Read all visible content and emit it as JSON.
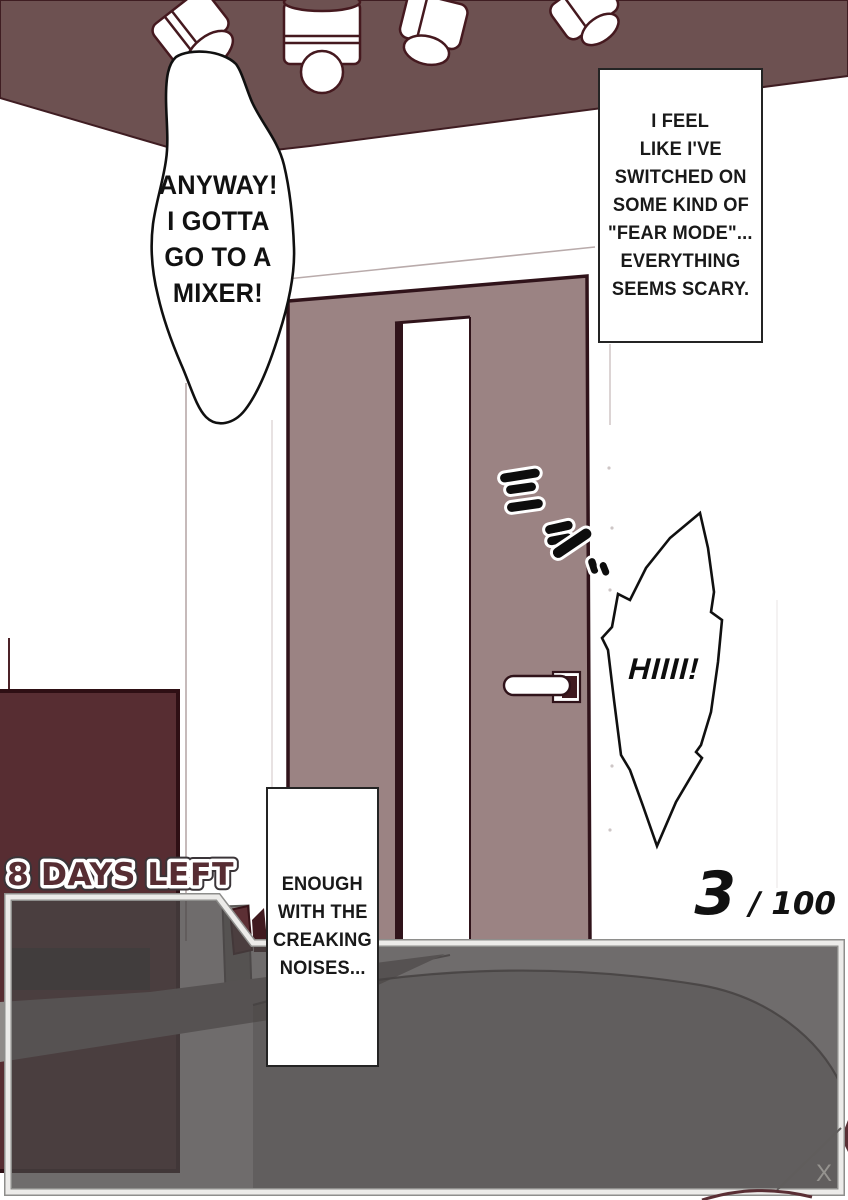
{
  "panel": {
    "speech_mixer": {
      "lines": [
        "ANYWAY!",
        "I GOTTA",
        "GO TO A",
        "MIXER!"
      ]
    },
    "caption_fear": {
      "lines": [
        "I FEEL",
        "LIKE I'VE",
        "SWITCHED ON",
        "SOME KIND OF",
        "\"FEAR MODE\"...",
        "EVERYTHING",
        "SEEMS SCARY."
      ]
    },
    "speech_hiii": {
      "text": "HIIII!"
    },
    "caption_creaking": {
      "lines": [
        "ENOUGH",
        "WITH THE",
        "CREAKING",
        "NOISES..."
      ]
    },
    "sfx_creak": {
      "name": "creak-sound-effect"
    }
  },
  "hud": {
    "days_left": "8 DAYS LEFT",
    "counter": {
      "current": "3",
      "total": "/ 100"
    },
    "dialog_close": "X"
  },
  "colors": {
    "ceiling": "#6d5151",
    "door": "#9b8383",
    "door_outline": "#30131a",
    "furniture_dark": "#572d32",
    "days_left_text": "#572d33",
    "dialog_fill": "rgba(70,67,66,0.78)",
    "dialog_border": "#ecebe9",
    "line_art": "#101010"
  }
}
